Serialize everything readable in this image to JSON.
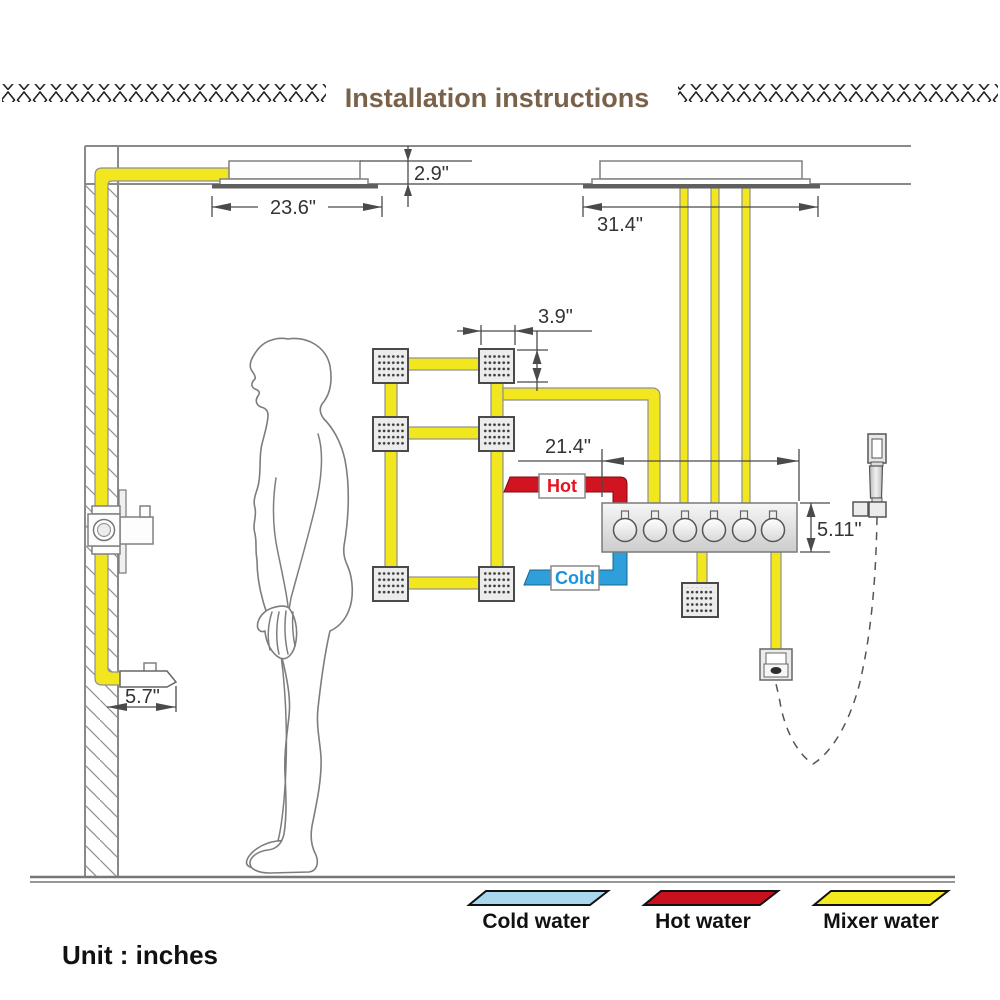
{
  "title": "Installation instructions",
  "unit_label": "Unit : inches",
  "dimensions": {
    "head_recess_height": "2.9\"",
    "left_head_width": "23.6\"",
    "right_head_width": "31.4\"",
    "jet_size": "3.9\"",
    "valve_offset": "21.4\"",
    "valve_height": "5.11\"",
    "spout_length": "5.7\""
  },
  "pipe_tags": {
    "hot": "Hot",
    "cold": "Cold"
  },
  "legend": [
    {
      "label": "Cold water",
      "color": "#a9d7ee"
    },
    {
      "label": "Hot water",
      "color": "#c8101e"
    },
    {
      "label": "Mixer water",
      "color": "#f3e91d"
    }
  ],
  "colors": {
    "title": "#796249",
    "pipe_yellow": "#f2e71f",
    "hot_red": "#d11420",
    "cold_blue": "#2f9fdc",
    "hot_text": "#e8111f",
    "cold_text": "#1b93d8"
  }
}
